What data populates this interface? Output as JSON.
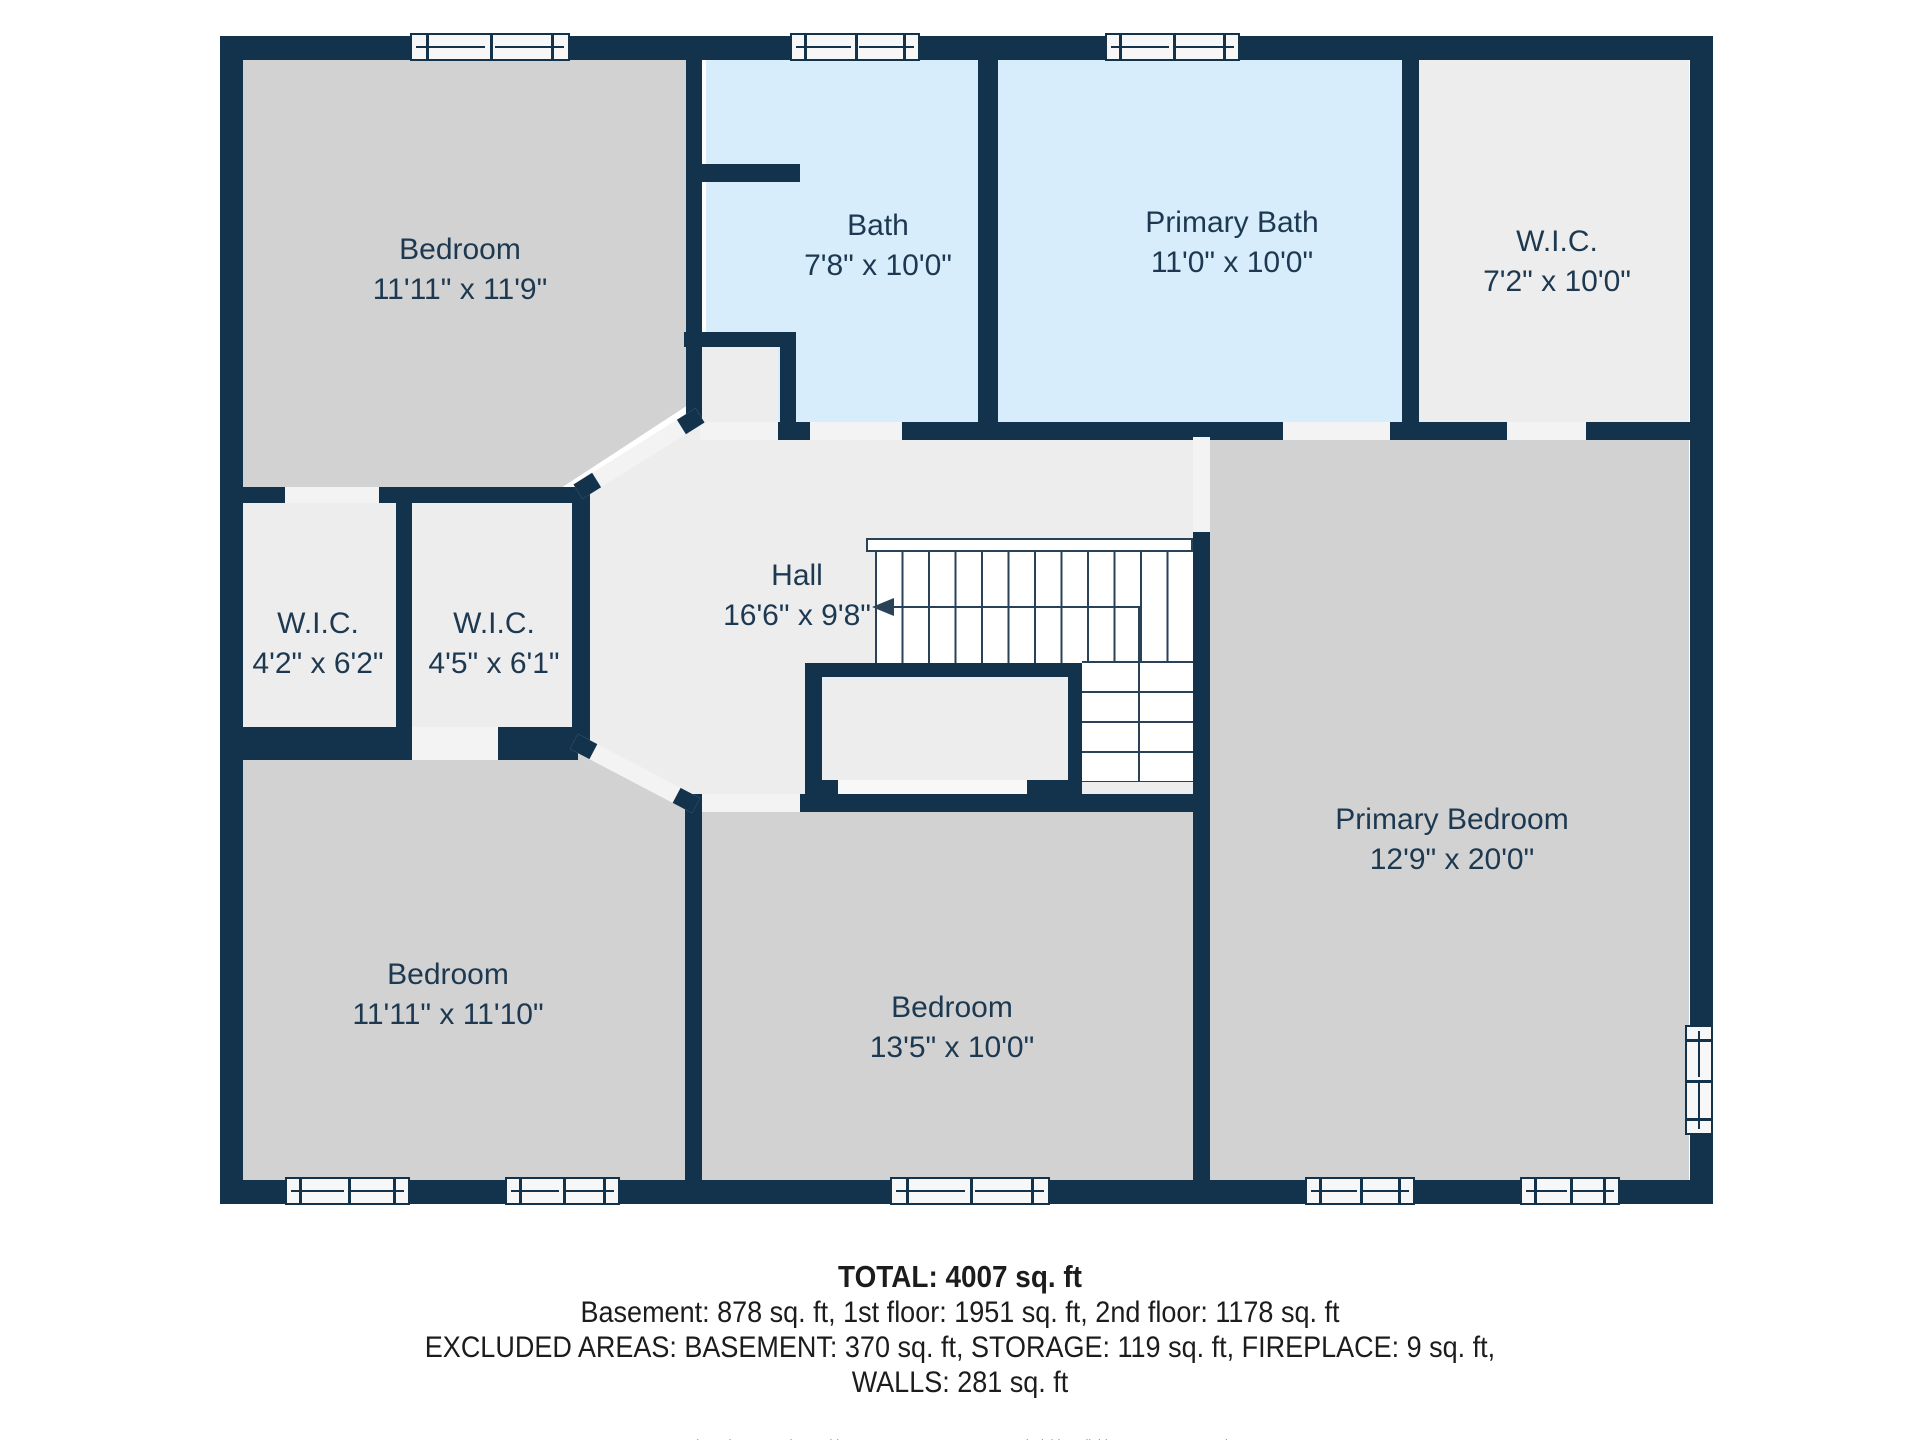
{
  "floor_plan": {
    "colors": {
      "wall": "#13334d",
      "gray": "#d2d2d2",
      "light": "#ededed",
      "blue": "#d7edfb",
      "gap": "#f3f3f3",
      "winbg": "#f7f7f7",
      "line": "#2a4257",
      "label": "#1d3951",
      "text": "#1c1c1c"
    },
    "rooms": [
      {
        "name": "Bedroom",
        "dims": "11'11\" x 11'9\""
      },
      {
        "name": "Bath",
        "dims": "7'8\" x 10'0\""
      },
      {
        "name": "Primary Bath",
        "dims": "11'0\" x 10'0\""
      },
      {
        "name": "W.I.C.",
        "dims": "7'2\" x 10'0\""
      },
      {
        "name": "W.I.C.",
        "dims": "4'2\" x 6'2\""
      },
      {
        "name": "W.I.C.",
        "dims": "4'5\" x 6'1\""
      },
      {
        "name": "Hall",
        "dims": "16'6\" x 9'8\""
      },
      {
        "name": "Primary Bedroom",
        "dims": "12'9\" x 20'0\""
      },
      {
        "name": "Bedroom",
        "dims": "11'11\" x 11'10\""
      },
      {
        "name": "Bedroom",
        "dims": "13'5\" x 10'0\""
      }
    ]
  },
  "summary": {
    "total": "TOTAL: 4007 sq. ft",
    "floors": "Basement: 878 sq. ft, 1st floor: 1951 sq. ft, 2nd floor: 1178 sq. ft",
    "excluded": "EXCLUDED AREAS: BASEMENT: 370 sq. ft, STORAGE: 119 sq. ft, FIREPLACE: 9 sq. ft,",
    "walls": "WALLS: 281 sq. ft",
    "disclaimer": "Floor Plan Created By Cubicasa App. Measurements Deemed Highly Reliable But Not Guaranteed."
  }
}
